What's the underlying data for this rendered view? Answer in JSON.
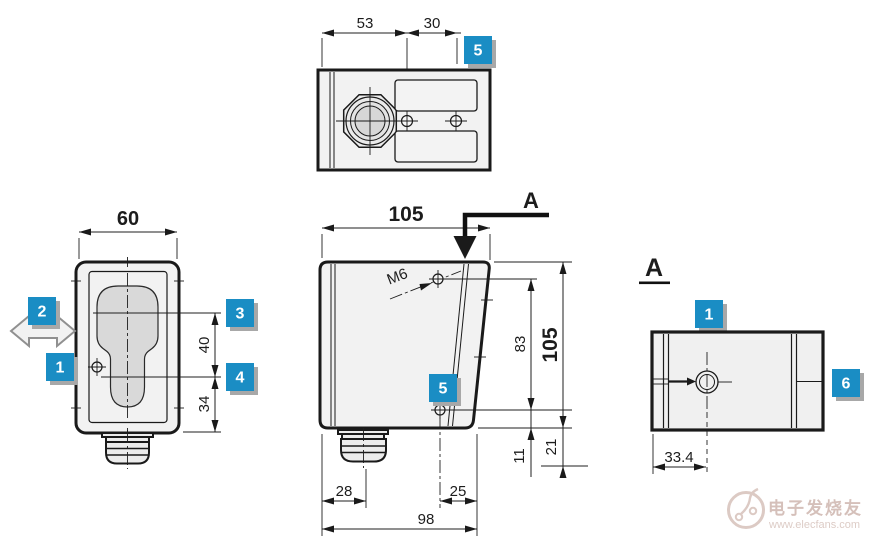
{
  "views": {
    "top": {
      "dims": {
        "left": "53",
        "right": "30"
      },
      "badge": "5"
    },
    "front": {
      "dims": {
        "width": "60",
        "upper": "40",
        "lower": "34"
      },
      "badges": {
        "move": "2",
        "body": "1",
        "upper_line": "3",
        "lower_line": "4"
      }
    },
    "side": {
      "dims": {
        "width": "105",
        "height": "105",
        "holes": "83",
        "hole_to_bottom": "11",
        "gland": "21",
        "left": "28",
        "hole_right": "25",
        "bottom": "98"
      },
      "thread": "M6",
      "section_arrow": "A",
      "badge": "5"
    },
    "section_a": {
      "label": "A",
      "dims": {
        "hole_offset": "33.4"
      },
      "badges": {
        "top": "1",
        "right": "6"
      }
    }
  },
  "watermark": {
    "brand": "电子发烧友",
    "url": "www.elecfans.com"
  },
  "colors": {
    "badge": "#1a8dc4",
    "line": "#1a1a1a",
    "body_fill": "#f2f2f2",
    "lens_fill": "#d9d9d9",
    "watermark": "#d5c0ba"
  }
}
